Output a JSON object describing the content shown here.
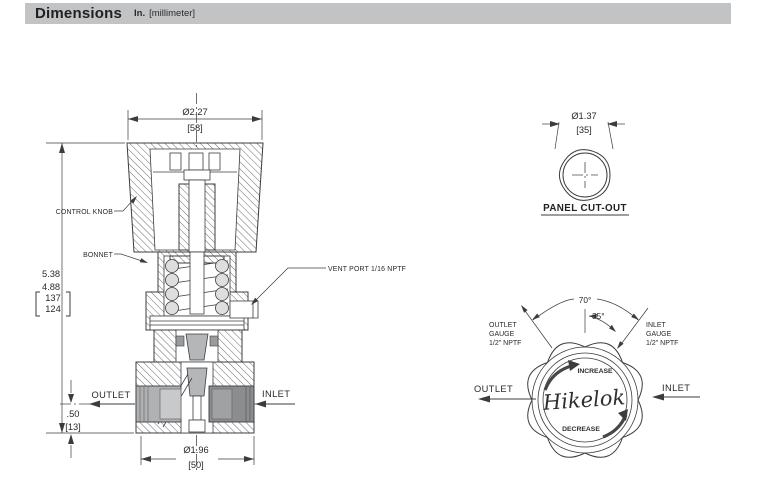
{
  "header": {
    "title": "Dimensions",
    "unit_primary": "In.",
    "unit_secondary": "[millimeter]"
  },
  "front_view": {
    "callouts": {
      "control_knob": "CONTROL KNOB",
      "bonnet": "BONNET",
      "vent_port": "VENT PORT 1/16 NPTF"
    },
    "ports": {
      "outlet": "OUTLET",
      "inlet": "INLET"
    },
    "dims": {
      "knob_dia": {
        "in": "Ø2.27",
        "mm": "[58]"
      },
      "height": {
        "in_max": "5.38",
        "in_min": "4.88",
        "mm_max": "137",
        "mm_min": "124"
      },
      "port_height": {
        "in": ".50",
        "mm": "[13]"
      },
      "body_dia": {
        "in": "Ø1.96",
        "mm": "[50]"
      }
    }
  },
  "panel_cutout": {
    "dia": {
      "in": "Ø1.37",
      "mm": "[35]"
    },
    "caption": "PANEL CUT-OUT"
  },
  "top_view": {
    "angles": {
      "outer": "70°",
      "inner": "35°"
    },
    "outlet_gauge": {
      "l1": "OUTLET",
      "l2": "GAUGE",
      "l3": "1/2\" NPTF"
    },
    "inlet_gauge": {
      "l1": "INLET",
      "l2": "GAUGE",
      "l3": "1/2\" NPTF"
    },
    "ports": {
      "outlet": "OUTLET",
      "inlet": "INLET"
    },
    "rotation": {
      "increase": "INCREASE",
      "decrease": "DECREASE"
    },
    "brand": "Hikelok"
  },
  "colors": {
    "header_bg": "#c2c3c5",
    "line": "#3b3c3f",
    "text": "#28292b",
    "fitting_light": "#b0b1b3",
    "fitting_dark": "#8c8d8f",
    "part_gray": "#b5b6b8"
  }
}
